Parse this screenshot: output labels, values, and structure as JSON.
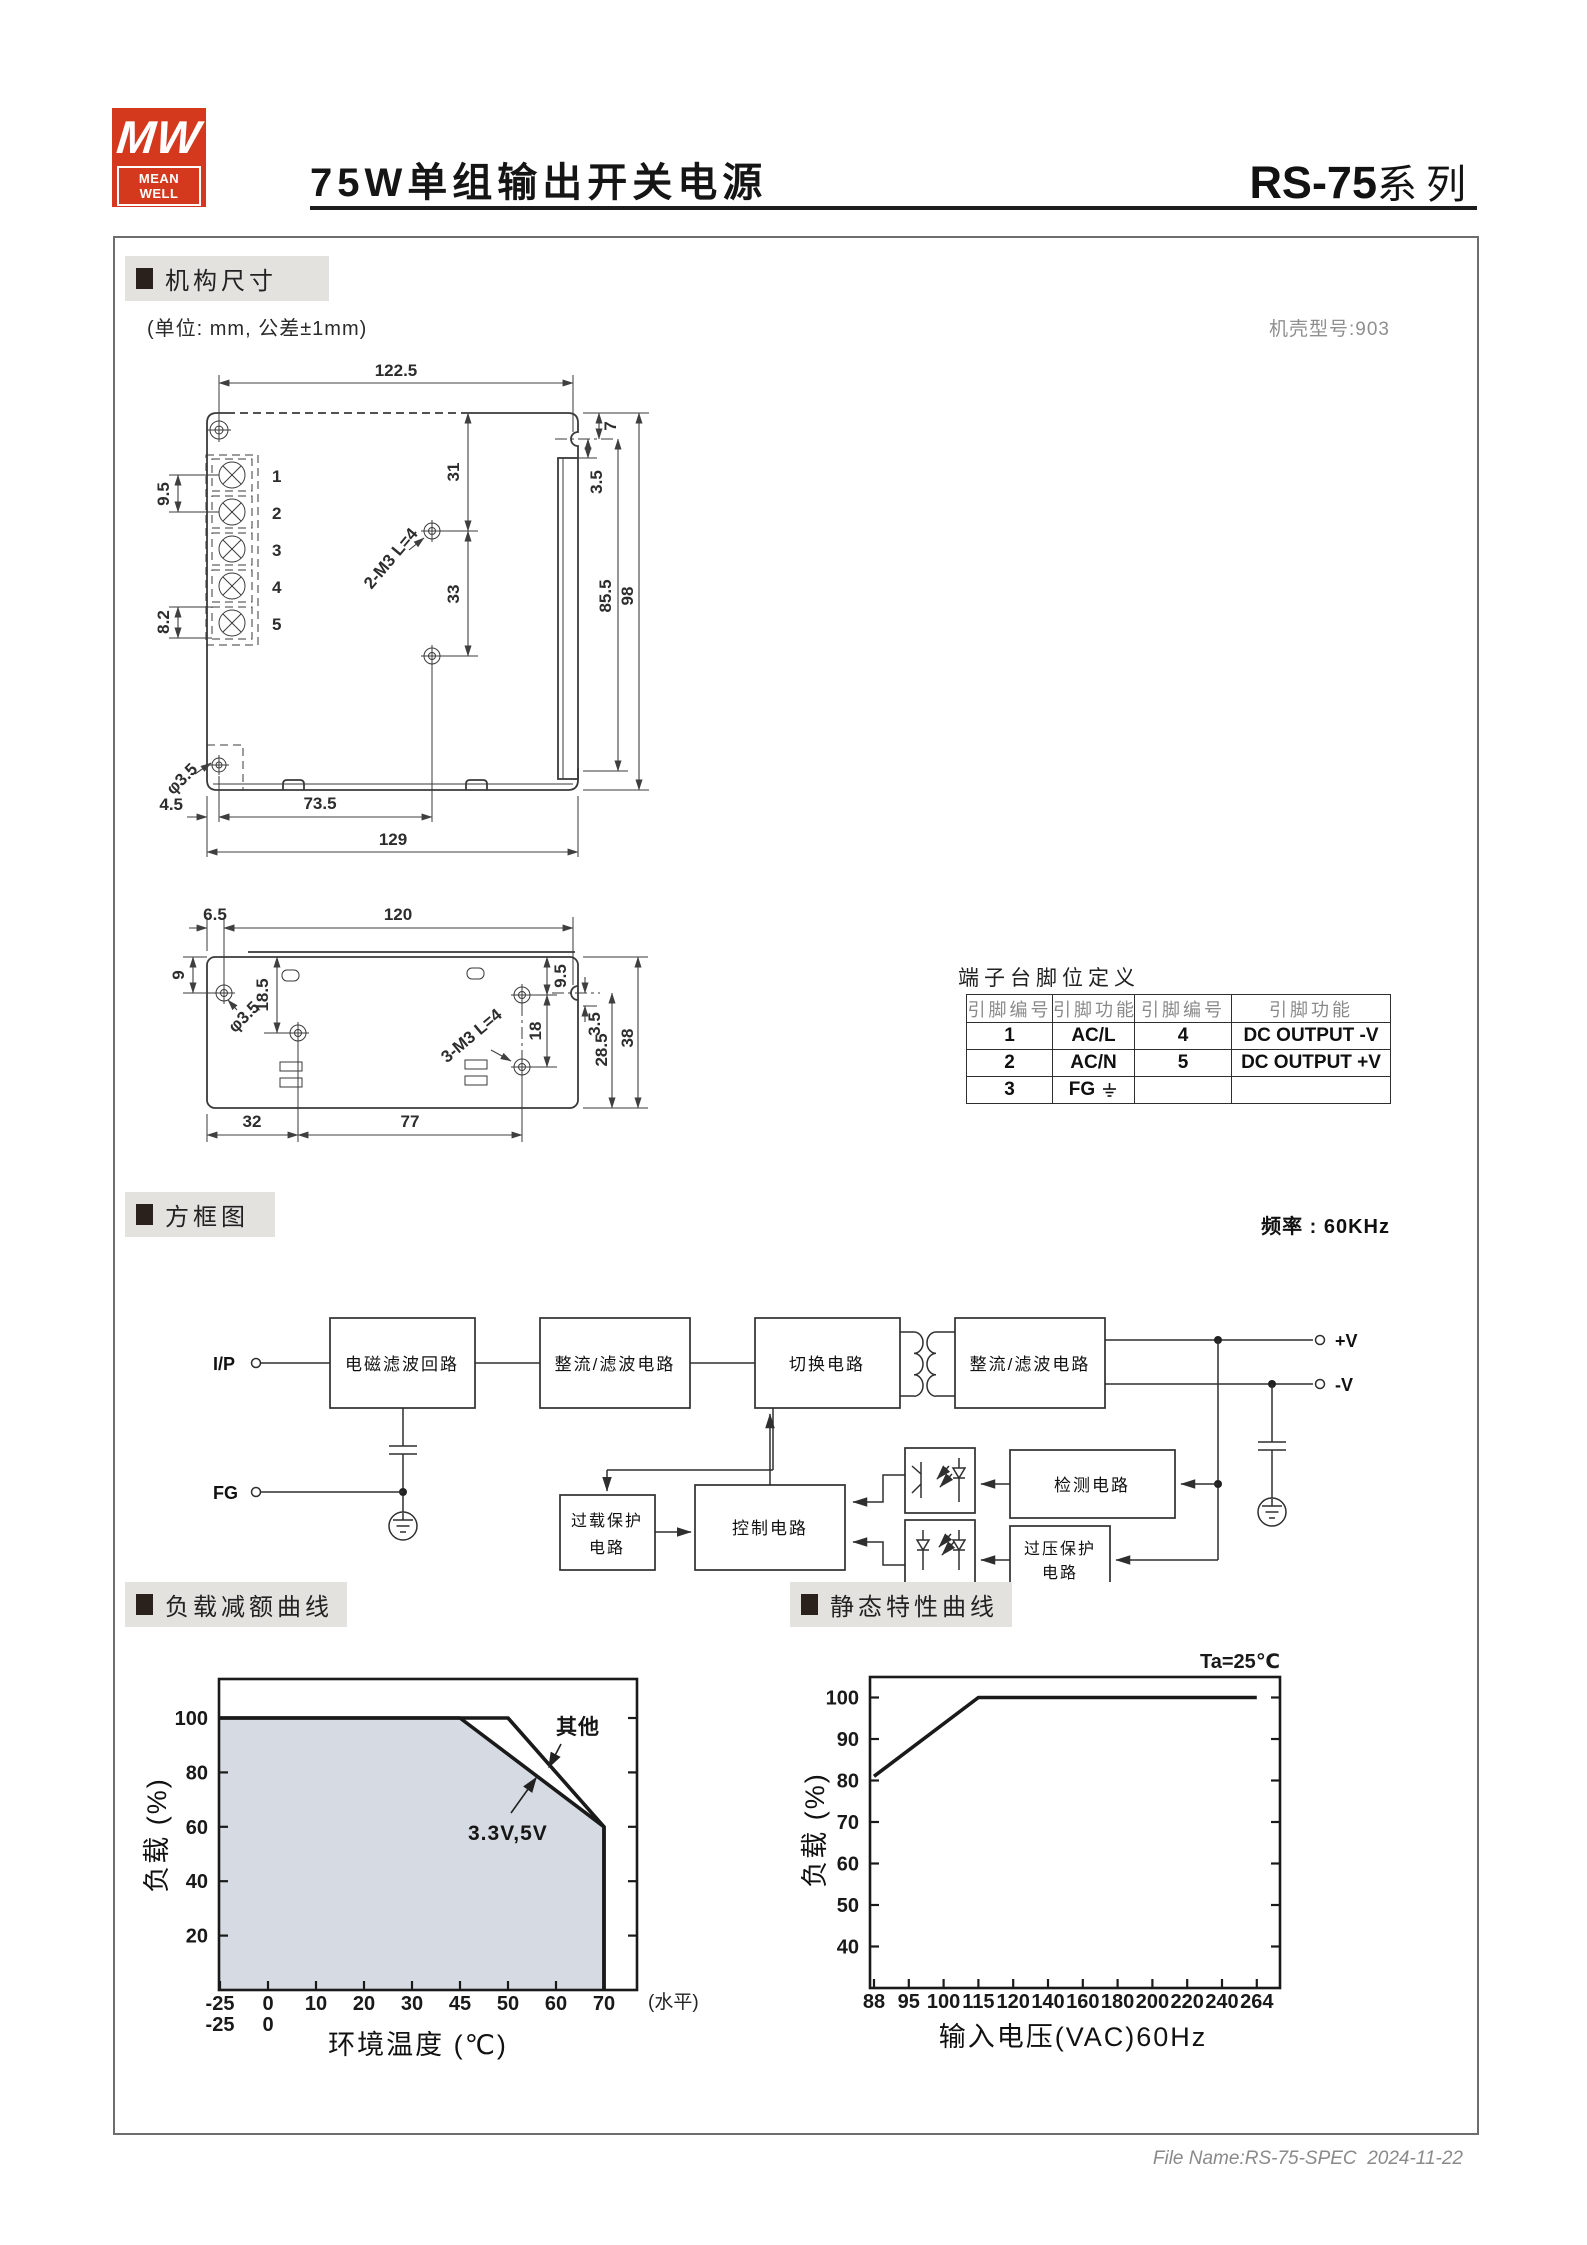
{
  "header": {
    "logo": {
      "monogram": "MW",
      "brand": "MEAN WELL",
      "color": "#d4391d"
    },
    "title": "75W单组输出开关电源",
    "series": "RS-75",
    "series_suffix": "系列"
  },
  "sections": {
    "mechanical": {
      "label": "机构尺寸",
      "unit_note": "(单位: mm, 公差±1mm)",
      "case_note": "机壳型号:903"
    },
    "block": {
      "label": "方框图",
      "freq_note": "频率 : 60KHz"
    },
    "derating": {
      "label": "负载减额曲线"
    },
    "static": {
      "label": "静态特性曲线"
    }
  },
  "drawing_top": {
    "w_top": "122.5",
    "pitch": "9.5",
    "term": "8.2",
    "hole_top": "31",
    "hole_span": "33",
    "screw_note": "2-M3 L=4",
    "notch_gap": "7",
    "notch_depth": "3.5",
    "h_inner": "85.5",
    "h_total": "98",
    "hole_dia": "φ3.5",
    "off_x": "4.5",
    "hole_x": "73.5",
    "w_total": "129",
    "terminals": [
      "1",
      "2",
      "3",
      "4",
      "5"
    ]
  },
  "drawing_side": {
    "off": "6.5",
    "w_top": "120",
    "screw_y": "9",
    "hole1_y": "18.5",
    "hole_dia": "φ3.5",
    "screw_note": "3-M3 L=4",
    "rh1": "9.5",
    "rh2": "18",
    "notch_depth": "3.5",
    "d_inner": "28.5",
    "d_total": "38",
    "seg1": "32",
    "seg2": "77"
  },
  "pin_table": {
    "title": "端子台脚位定义",
    "headers": [
      "引脚编号",
      "引脚功能",
      "引脚编号",
      "引脚功能"
    ],
    "rows": [
      [
        "1",
        "AC/L",
        "4",
        "DC OUTPUT -V"
      ],
      [
        "2",
        "AC/N",
        "5",
        "DC OUTPUT +V"
      ],
      [
        "3",
        "FG",
        "",
        ""
      ]
    ]
  },
  "block_diagram": {
    "input": "I/P",
    "fg": "FG",
    "emi": "电磁滤波回路",
    "rect1": "整流/滤波电路",
    "switch": "切换电路",
    "rect2": "整流/滤波电路",
    "vplus": "+V",
    "vminus": "-V",
    "overload": [
      "过载保护",
      "电路"
    ],
    "control": "控制电路",
    "detect": "检测电路",
    "ovp": [
      "过压保护",
      "电路"
    ]
  },
  "chart_data": [
    {
      "type": "area",
      "title": "负载减额曲线",
      "xlabel": "环境温度 (℃)",
      "ylabel": "负载 (%)",
      "x_axis_note": "(水平)",
      "x_ticks": [
        -25,
        0,
        10,
        20,
        30,
        45,
        50,
        60,
        70
      ],
      "x_ticks_second_row": [
        -25,
        0
      ],
      "y_ticks": [
        20,
        40,
        60,
        80,
        100
      ],
      "ylim": [
        0,
        114
      ],
      "grid": false,
      "series": [
        {
          "name": "其他",
          "points": [
            [
              -25,
              100
            ],
            [
              50,
              100
            ],
            [
              70,
              60
            ],
            [
              70,
              0
            ]
          ]
        },
        {
          "name": "3.3V,5V",
          "points": [
            [
              -25,
              100
            ],
            [
              45,
              100
            ],
            [
              70,
              60
            ],
            [
              70,
              0
            ]
          ],
          "area_fill": true
        }
      ],
      "fill_color": "#d6dbe3",
      "line_color": "#1a1a1a"
    },
    {
      "type": "line",
      "title": "静态特性曲线",
      "annotation": "Ta=25℃",
      "xlabel": "输入电压(VAC)60Hz",
      "ylabel": "负载 (%)",
      "x_ticks": [
        88,
        95,
        100,
        115,
        120,
        140,
        160,
        180,
        200,
        220,
        240,
        264
      ],
      "y_ticks": [
        40,
        50,
        60,
        70,
        80,
        90,
        100
      ],
      "ylim": [
        30,
        105
      ],
      "grid": false,
      "series": [
        {
          "name": "负载",
          "points": [
            [
              88,
              81
            ],
            [
              115,
              100
            ],
            [
              264,
              100
            ]
          ]
        }
      ],
      "line_color": "#1a1a1a"
    }
  ],
  "footer": {
    "file_note": "File Name:RS-75-SPEC  2024-11-22"
  }
}
